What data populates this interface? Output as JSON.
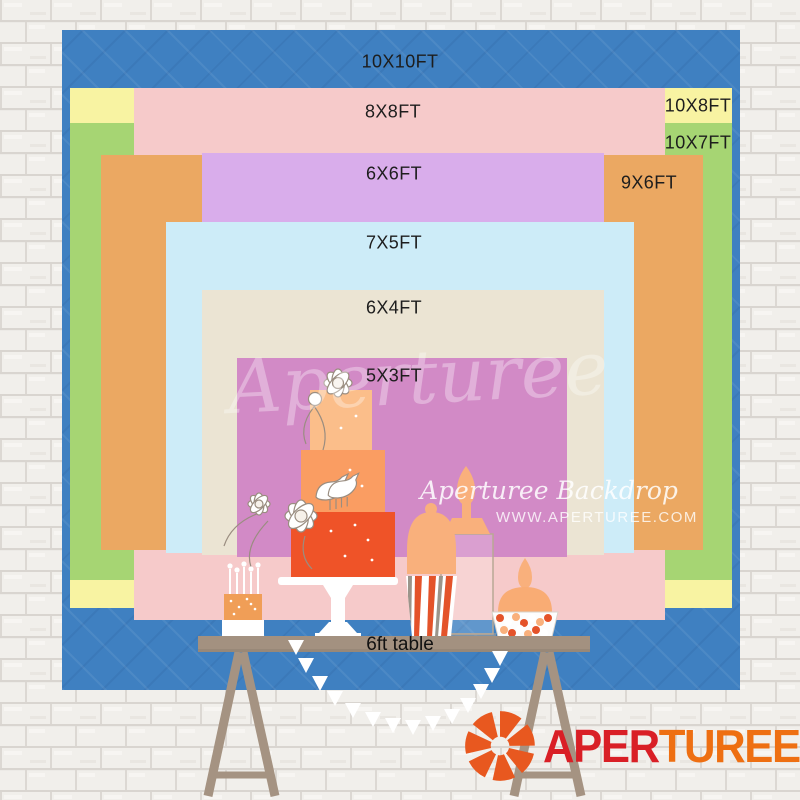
{
  "sizes": [
    {
      "label": "10X10FT",
      "color": "#3f80c1",
      "x": 62,
      "y": 30,
      "w": 678,
      "h": 660,
      "label_x": 400,
      "label_y": 62,
      "pattern": true
    },
    {
      "label": "10X8FT",
      "color": "#f8f3a2",
      "x": 70,
      "y": 88,
      "w": 662,
      "h": 520,
      "label_x": 698,
      "label_y": 106,
      "pattern": false
    },
    {
      "label": "10X7FT",
      "color": "#a6d573",
      "x": 70,
      "y": 123,
      "w": 662,
      "h": 457,
      "label_x": 698,
      "label_y": 143,
      "pattern": false
    },
    {
      "label": "8X8FT",
      "color": "#f6caca",
      "x": 134,
      "y": 88,
      "w": 531,
      "h": 532,
      "label_x": 393,
      "label_y": 112,
      "pattern": false
    },
    {
      "label": "9X6FT",
      "color": "#eba862",
      "x": 101,
      "y": 155,
      "w": 602,
      "h": 395,
      "label_x": 649,
      "label_y": 183,
      "pattern": false
    },
    {
      "label": "6X6FT",
      "color": "#d9adeb",
      "x": 202,
      "y": 153,
      "w": 402,
      "h": 398,
      "label_x": 394,
      "label_y": 174,
      "pattern": false
    },
    {
      "label": "7X5FT",
      "color": "#cdecf8",
      "x": 166,
      "y": 222,
      "w": 468,
      "h": 331,
      "label_x": 394,
      "label_y": 243,
      "pattern": false
    },
    {
      "label": "6X4FT",
      "color": "#ebe4d3",
      "x": 202,
      "y": 290,
      "w": 402,
      "h": 265,
      "label_x": 394,
      "label_y": 308,
      "pattern": false
    },
    {
      "label": "5X3FT",
      "color": "#d28ac6",
      "x": 237,
      "y": 358,
      "w": 330,
      "h": 199,
      "label_x": 394,
      "label_y": 376,
      "pattern": false
    }
  ],
  "table": {
    "label": "6ft table"
  },
  "watermark": {
    "center": "Aperturee",
    "line1": "Aperturee Backdrop",
    "line2": "WWW.APERTUREE.COM"
  },
  "logo": {
    "part1": "APER",
    "part2": "TUREE",
    "part1_color": "#d91f26",
    "part2_color": "#ee6f12",
    "icon": "aperture-shutter-icon",
    "icon_color": "#e8581f"
  },
  "illustration": {
    "items": [
      "mini-cake-with-candles",
      "three-tier-cake-on-stand",
      "popcorn-box",
      "apothecary-jar",
      "candy-jar",
      "bunting-garland",
      "trestle-table"
    ]
  }
}
